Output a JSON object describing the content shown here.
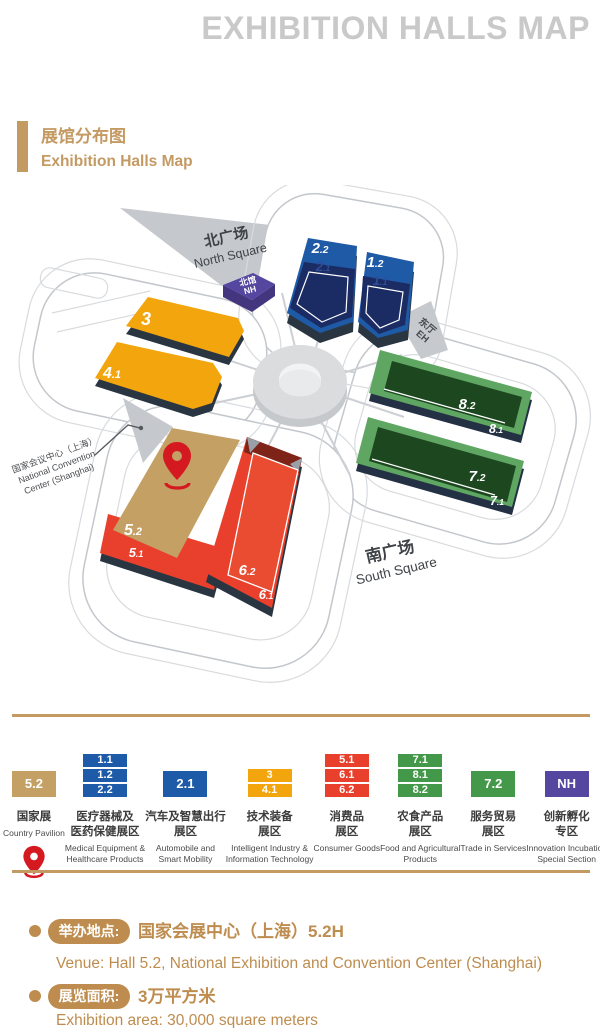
{
  "page_title": "EXHIBITION HALLS MAP",
  "section": {
    "title_zh": "展馆分布图",
    "title_en": "Exhibition Halls Map"
  },
  "map": {
    "north_square": {
      "zh": "北广场",
      "en": "North Square"
    },
    "south_square": {
      "zh": "南广场",
      "en": "South Square"
    },
    "north_hall": {
      "zh": "北馆",
      "en": "NH"
    },
    "east_hall": {
      "zh": "东厅",
      "en": "EH"
    },
    "convention_center": {
      "zh": "国家会议中心（上海）",
      "en1": "National Convention",
      "en2": "Center (Shanghai)"
    },
    "halls": {
      "h3": {
        "b": "3",
        "s": ""
      },
      "h41": {
        "b": "4",
        "s": ".1"
      },
      "h22": {
        "b": "2",
        "s": ".2"
      },
      "h21": {
        "b": "2",
        "s": ".1"
      },
      "h12": {
        "b": "1",
        "s": ".2"
      },
      "h11": {
        "b": "1",
        "s": ".1"
      },
      "h82": {
        "b": "8",
        "s": ".2"
      },
      "h81": {
        "b": "8",
        "s": ".1"
      },
      "h72": {
        "b": "7",
        "s": ".2"
      },
      "h71": {
        "b": "7",
        "s": ".1"
      },
      "h52": {
        "b": "5",
        "s": ".2"
      },
      "h51": {
        "b": "5",
        "s": ".1"
      },
      "h62": {
        "b": "6",
        "s": ".2"
      },
      "h61": {
        "b": "6",
        "s": ".1"
      }
    }
  },
  "legend": {
    "items": [
      {
        "boxes": [
          "5.2"
        ],
        "color": "#C5A065",
        "zh": [
          "国家展"
        ],
        "en": [
          "Country Pavilion"
        ],
        "pin": true
      },
      {
        "boxes": [
          "1.1",
          "1.2",
          "2.2"
        ],
        "color": "#1D5AA8",
        "zh": [
          "医疗器械及",
          "医药保健展区"
        ],
        "en": [
          "Medical Equipment &",
          "Healthcare Products"
        ]
      },
      {
        "boxes": [
          "2.1"
        ],
        "color": "#1D5AA8",
        "zh": [
          "汽车及智慧出行",
          "展区"
        ],
        "en": [
          "Automobile and",
          "Smart Mobility"
        ]
      },
      {
        "boxes": [
          "3",
          "4.1"
        ],
        "color": "#F2A50C",
        "zh": [
          "技术装备",
          "展区"
        ],
        "en": [
          "Intelligent Industry &",
          "Information Technology"
        ]
      },
      {
        "boxes": [
          "5.1",
          "6.1",
          "6.2"
        ],
        "color": "#E8402D",
        "zh": [
          "消费品",
          "展区"
        ],
        "en": [
          "Consumer Goods"
        ]
      },
      {
        "boxes": [
          "7.1",
          "8.1",
          "8.2"
        ],
        "color": "#44984A",
        "zh": [
          "农食产品",
          "展区"
        ],
        "en": [
          "Food and Agricultural",
          "Products"
        ]
      },
      {
        "boxes": [
          "7.2"
        ],
        "color": "#44984A",
        "zh": [
          "服务贸易",
          "展区"
        ],
        "en": [
          "Trade in Services"
        ]
      },
      {
        "boxes": [
          "NH"
        ],
        "color": "#5546A0",
        "zh": [
          "创新孵化",
          "专区"
        ],
        "en": [
          "Innovation Incubation",
          "Special Section"
        ]
      }
    ]
  },
  "info": {
    "venue_label": "举办地点:",
    "venue_zh": "国家会展中心（上海）5.2H",
    "venue_en": "Venue: Hall 5.2, National Exhibition and Convention Center (Shanghai)",
    "area_label": "展览面积:",
    "area_zh": "3万平方米",
    "area_en": "Exhibition area: 30,000 square meters"
  },
  "colors": {
    "gold": "#C49A63",
    "gold_text": "#BE8C4E",
    "title_gray": "#C9C9C9",
    "blue": "#1E5AA6",
    "navy": "#1B2B63",
    "yellow": "#F2A50C",
    "red": "#E8402D",
    "maroon": "#7E2317",
    "green": "#5EA662",
    "green_dark": "#1C471F",
    "purple": "#5546A0",
    "tan": "#C5A065",
    "pin_red": "#D51920",
    "gray": "#C5C8CC"
  }
}
